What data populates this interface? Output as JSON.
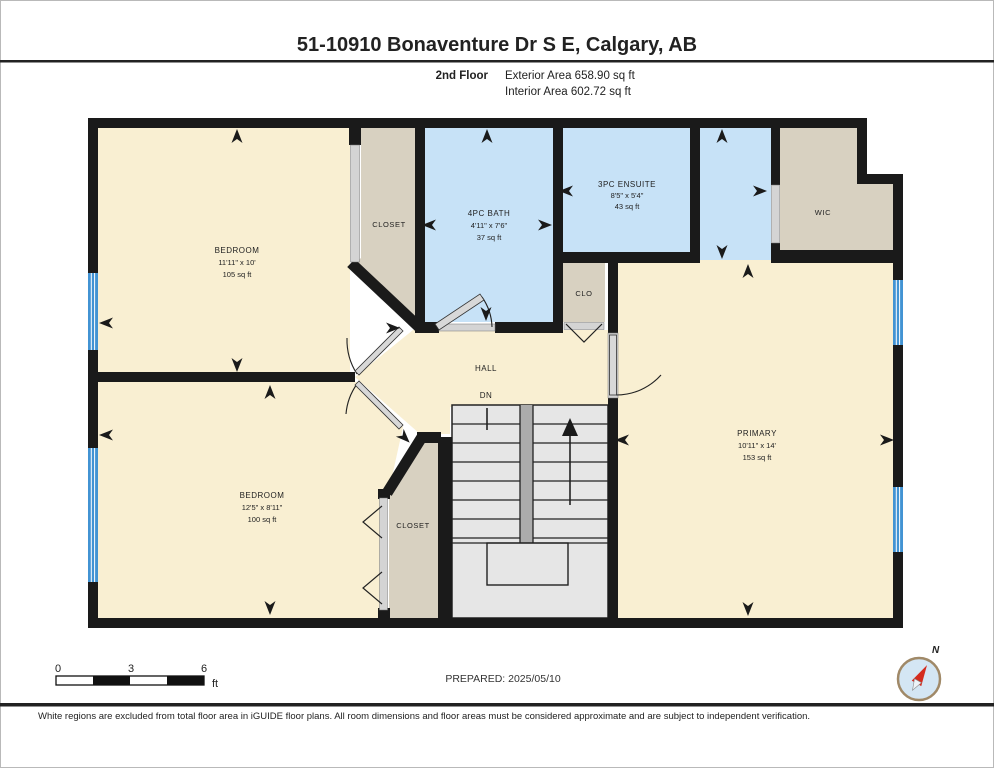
{
  "header": {
    "title": "51-10910 Bonaventure Dr S E, Calgary, AB",
    "floor_label": "2nd Floor",
    "exterior_area": "Exterior Area 658.90 sq ft",
    "interior_area": "Interior Area 602.72 sq ft"
  },
  "rooms": {
    "bedroom1": {
      "name": "BEDROOM",
      "dims": "11'11\" x 10'",
      "area": "105 sq ft"
    },
    "closet1": {
      "name": "CLOSET"
    },
    "bath": {
      "name": "4PC BATH",
      "dims": "4'11\" x 7'6\"",
      "area": "37 sq ft"
    },
    "ensuite": {
      "name": "3PC ENSUITE",
      "dims": "8'5\" x 5'4\"",
      "area": "43 sq ft"
    },
    "wic": {
      "name": "WIC"
    },
    "clo": {
      "name": "CLO"
    },
    "hall": {
      "name": "HALL",
      "stairs_label": "DN"
    },
    "closet2": {
      "name": "CLOSET"
    },
    "bedroom2": {
      "name": "BEDROOM",
      "dims": "12'5\" x 8'11\"",
      "area": "100 sq ft"
    },
    "primary": {
      "name": "PRIMARY",
      "dims": "10'11\" x 14'",
      "area": "153 sq ft"
    }
  },
  "footer": {
    "prepared": "PREPARED: 2025/05/10",
    "disclaimer": "White regions are excluded from total floor area in iGUIDE floor plans. All room dimensions and floor areas must be considered approximate and are subject to independent verification.",
    "scale": {
      "start": "0",
      "mid": "3",
      "end": "6",
      "unit": "ft"
    },
    "compass_label": "N"
  },
  "colors": {
    "room_yellow": "#F9EFD2",
    "room_blue": "#C7E2F7",
    "closet_beige": "#D8D1C1",
    "wall_black": "#1a1a1a",
    "window_blue": "#4293D3",
    "stairs_gray": "#E6E6E6",
    "compass_red": "#D42B1E"
  }
}
